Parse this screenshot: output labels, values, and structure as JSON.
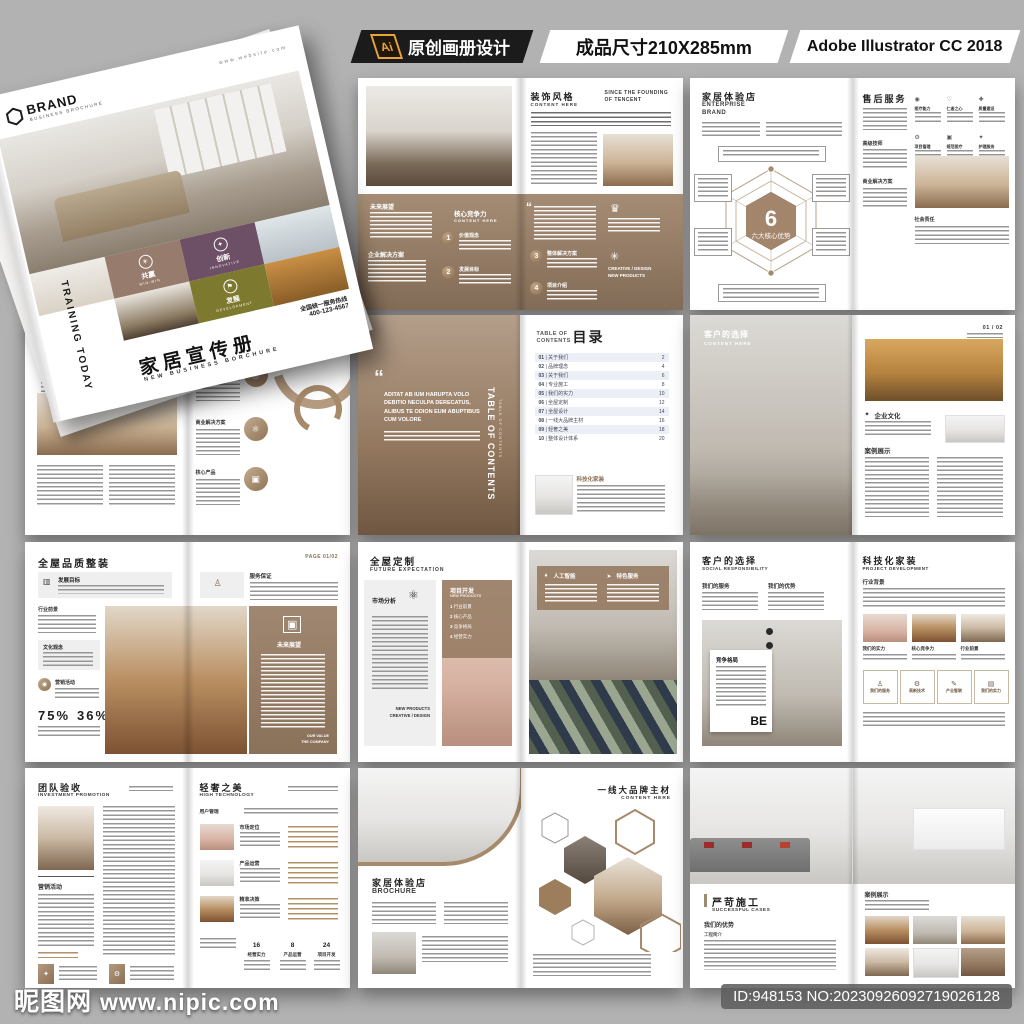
{
  "header": {
    "ai": "Ai",
    "title": "原创画册设计",
    "size": "成品尺寸210X285mm",
    "app": "Adobe Illustrator CC 2018"
  },
  "watermark": {
    "site": "昵图网",
    "url": "www.nipic.com",
    "id": "ID:948153 NO:20230926092719026128"
  },
  "colors": {
    "page_bg": "#b2b2b2",
    "accent": "#a78a6b",
    "tan": "#9b8173",
    "purple": "#6d4f66",
    "olive": "#7d7a2f",
    "bar_dark": "#1b1b1b",
    "ai_orange": "#e8a33d"
  },
  "icons": {
    "hexagon": "⬡",
    "win": "☀",
    "innovate": "✦",
    "develop": "⚑",
    "chart": "▦",
    "headset": "◎",
    "network": "⚛",
    "monitor": "▣",
    "person": "♙",
    "gear": "⚙",
    "pen": "✎",
    "book": "▤",
    "trophy": "♛",
    "creative": "✳",
    "pin": "♦",
    "rocket": "➤",
    "star": "✦",
    "target": "◉",
    "heart": "♡",
    "cross": "✚",
    "shield": "▲",
    "doc": "▥",
    "quote": "“"
  },
  "cover": {
    "brand": "BRAND",
    "brand_sub": "BUSINESS BROCHURE",
    "website": "www.website.com",
    "spine": "TRAINING TODAY",
    "tile_win": "共赢",
    "tile_win_en": "WIN-WIN",
    "tile_innov": "创新",
    "tile_innov_en": "INNOVATIVE",
    "tile_dev": "发展",
    "tile_dev_en": "DEVELOPMENT",
    "title": "家居宣传册",
    "subtitle": "NEW BUSINESS BORCHURE",
    "hotline_label": "全国统一服务热线",
    "hotline": "400-123-4567"
  },
  "st": {
    "title": "装饰风格",
    "sub": "CONTENT HERE",
    "note1": "SINCE THE FOUNDING",
    "note2": "OF TENCENT",
    "future": "未来展望",
    "core": "核心竞争力",
    "core_sub": "CONTENT HERE",
    "n1": "1",
    "n1l": "价值观念",
    "n2": "2",
    "n2l": "发展目标",
    "sol": "企业解决方案",
    "n3": "3",
    "n3l": "整体解决方案",
    "n4": "4",
    "n4l": "项目介绍",
    "creative1": "CREATIVE / DESIGN",
    "creative2": "NEW PRODUCTS",
    "quote": "“"
  },
  "br": {
    "title": "家居体验店",
    "sub1": "ENTERPRISE",
    "sub2": "BRAND",
    "num": "6",
    "num_label": "六大核心优势",
    "rt": "售后服务",
    "l1": "高级技师",
    "l2": "商业解决方案",
    "l3": "社会责任",
    "g1": "医疗能力",
    "g2": "仁者之心",
    "g3": "质量建设",
    "g4": "项目管理",
    "g5": "规范医疗",
    "g6": "护理服务"
  },
  "pr": {
    "title": "科技化家装",
    "sub": "OUR PRODUCTS",
    "c1": "发展源自创新",
    "c2": "产品优势",
    "r1": "产业智联",
    "r2": "商业解决方案",
    "r3": "核心产品"
  },
  "tc": {
    "en1": "TABLE OF",
    "en2": "CONTENTS",
    "title": "目录",
    "side": "TABLE OF CONTENTS",
    "side2": "TABLE OF CONTENTS",
    "quote": "“",
    "quote_text": "ADITAT AB IUM HARUPTA VOLO DEBITIO NECULPA DERECATUS, ALIBUS TE ODION EUM ABUPTIBUS CUM VOLORE",
    "blurb": "科技化家装",
    "items": [
      {
        "no": "01",
        "label": "关于我们",
        "page": "2"
      },
      {
        "no": "02",
        "label": "品牌理念",
        "page": "4"
      },
      {
        "no": "03",
        "label": "关于我们",
        "page": "6"
      },
      {
        "no": "04",
        "label": "专业施工",
        "page": "8"
      },
      {
        "no": "05",
        "label": "我们的实力",
        "page": "10"
      },
      {
        "no": "06",
        "label": "全屋定制",
        "page": "12"
      },
      {
        "no": "07",
        "label": "全屋设计",
        "page": "14"
      },
      {
        "no": "08",
        "label": "一线大品牌主材",
        "page": "16"
      },
      {
        "no": "09",
        "label": "轻奢之美",
        "page": "18"
      },
      {
        "no": "10",
        "label": "整体设计体系",
        "page": "20"
      }
    ]
  },
  "ch": {
    "title": "客户的选择",
    "sub": "CONTENT HERE",
    "page": "01 / 02",
    "sec1": "企业文化",
    "sec2": "案例展示"
  },
  "qu": {
    "title": "全屋品质整装",
    "page": "PAGE 01/02",
    "s1": "发展目标",
    "s2": "行业前景",
    "s3": "文化观念",
    "s4": "营销活动",
    "p1": "75%",
    "p2": "36%",
    "r1": "服务保证",
    "panel": "未来展望",
    "pf1": "OUR VALUE",
    "pf2": "THE COMPANY"
  },
  "cu": {
    "title": "全屋定制",
    "sub": "FUTURE EXPECTATION",
    "ml": "市场分析",
    "f1": "NEW PRODUCTS",
    "f2": "CREATIVE / DESIGN",
    "ot": "项目开发",
    "os": "NEW PRODUCTS",
    "i1": "1",
    "i1l": "行业前景",
    "i2": "2",
    "i2l": "核心产品",
    "i3": "3",
    "i3l": "竞争格局",
    "i4": "4",
    "i4l": "经营实力",
    "b1": "人工智能",
    "b2": "特色服务"
  },
  "so": {
    "title": "客户的选择",
    "sub": "SOCIAL RESPONSIBILITY",
    "c1": "我们的服务",
    "c2": "我们的优势",
    "card": "竞争格局",
    "big": "BE",
    "rt": "科技化家装",
    "rsub": "PROJECT DEVELOPMENT",
    "sec1": "行业背景",
    "cap1": "我们的实力",
    "cap2": "核心竞争力",
    "cap3": "行业前景",
    "bx1": "我们的服务",
    "bx2": "高新技术",
    "bx3": "产业智联",
    "bx4": "我们的实力"
  },
  "te": {
    "title": "团队验收",
    "sub": "INVESTMENT PROMOTION",
    "l1": "营销活动",
    "rt": "轻奢之美",
    "rsub": "HIGH TECHNOLOGY",
    "top": "用户管理",
    "r1": "市场定位",
    "r2": "产品运营",
    "r3": "精准决策",
    "v1": "16",
    "s1": "经营实力",
    "v2": "8",
    "s2": "产品运营",
    "v3": "24",
    "s3": "项目开发"
  },
  "hx": {
    "lt": "家居体验店",
    "lsub": "BROCHURE",
    "rt": "一线大品牌主材",
    "rsub": "CONTENT HERE"
  },
  "ca": {
    "title": "严苛施工",
    "sub": "SUCCESSFUL CASES",
    "sec1": "我们的优势",
    "small": "工程简介",
    "rsec": "案例展示"
  }
}
